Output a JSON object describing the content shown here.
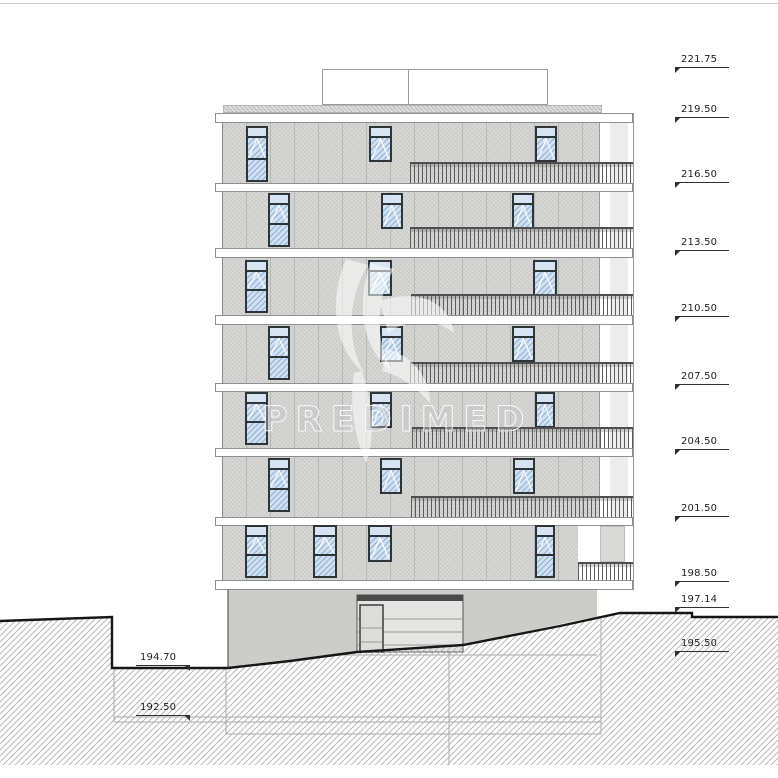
{
  "watermark": {
    "text": "PREDIMED"
  },
  "colors": {
    "facade": "#d8d8d6",
    "slab_border": "#8e8e8e",
    "window_frame": "#2e3539",
    "glazing": "#cfe0f2",
    "railing_bar": "#5c5c5c",
    "terrain_line": "#161616",
    "ground_hatch": "#b0b0b0",
    "structure_line": "#a8a8a8",
    "basement_wall": "#cccdc8",
    "garage_body": "#e4e4e2",
    "garage_top_bar": "#4a4a4a"
  },
  "levels_right": [
    {
      "label": "221.75",
      "y": 68
    },
    {
      "label": "219.50",
      "y": 118
    },
    {
      "label": "216.50",
      "y": 183
    },
    {
      "label": "213.50",
      "y": 251
    },
    {
      "label": "210.50",
      "y": 317
    },
    {
      "label": "207.50",
      "y": 385
    },
    {
      "label": "204.50",
      "y": 450
    },
    {
      "label": "201.50",
      "y": 517
    },
    {
      "label": "198.50",
      "y": 582
    },
    {
      "label": "197.14",
      "y": 608
    },
    {
      "label": "195.50",
      "y": 652
    }
  ],
  "levels_left": [
    {
      "label": "194.70",
      "y": 666,
      "x": 136
    },
    {
      "label": "192.50",
      "y": 716,
      "x": 136
    }
  ],
  "building": {
    "roof": {
      "x": 322,
      "y": 69,
      "w": 226,
      "h": 36,
      "divider_x": 408
    },
    "gravel": {
      "x": 223,
      "y": 105,
      "w": 379,
      "h": 8
    },
    "facade": {
      "x": 222,
      "y": 123,
      "w": 378,
      "h": 457
    },
    "right_zone": {
      "x": 600,
      "y": 123,
      "w": 33,
      "h": 457,
      "band_x": 610,
      "band_w": 18,
      "edge_x": 633,
      "edge_y1": 113,
      "edge_y2": 590
    },
    "slabs": [
      {
        "label": "219.50",
        "x": 215,
        "y": 113,
        "w": 418,
        "h": 10
      },
      {
        "label": "216.50",
        "x": 215,
        "y": 183,
        "w": 418,
        "h": 9
      },
      {
        "label": "213.50",
        "x": 215,
        "y": 248,
        "w": 418,
        "h": 10
      },
      {
        "label": "210.50",
        "x": 215,
        "y": 315,
        "w": 418,
        "h": 10
      },
      {
        "label": "207.50",
        "x": 215,
        "y": 383,
        "w": 418,
        "h": 9
      },
      {
        "label": "204.50",
        "x": 215,
        "y": 448,
        "w": 418,
        "h": 9
      },
      {
        "label": "201.50",
        "x": 215,
        "y": 517,
        "w": 418,
        "h": 9
      },
      {
        "label": "198.50",
        "x": 215,
        "y": 580,
        "w": 418,
        "h": 10
      }
    ],
    "floors": [
      {
        "win_top": 126,
        "short_h": 36,
        "tall_bottom": 182,
        "railing": {
          "x": 410,
          "w": 223,
          "top": 162,
          "h": 21
        },
        "windows": [
          {
            "x": 246,
            "w": 22,
            "type": "tall"
          },
          {
            "x": 369,
            "w": 23,
            "type": "short"
          },
          {
            "x": 535,
            "w": 22,
            "type": "short"
          }
        ]
      },
      {
        "win_top": 193,
        "short_h": 36,
        "tall_bottom": 247,
        "railing": {
          "x": 410,
          "w": 223,
          "top": 227,
          "h": 21
        },
        "windows": [
          {
            "x": 268,
            "w": 22,
            "type": "tall"
          },
          {
            "x": 381,
            "w": 22,
            "type": "short"
          },
          {
            "x": 512,
            "w": 22,
            "type": "short"
          }
        ]
      },
      {
        "win_top": 260,
        "short_h": 36,
        "tall_bottom": 313,
        "railing": {
          "x": 411,
          "w": 222,
          "top": 294,
          "h": 21
        },
        "windows": [
          {
            "x": 245,
            "w": 23,
            "type": "tall"
          },
          {
            "x": 368,
            "w": 24,
            "type": "short"
          },
          {
            "x": 533,
            "w": 24,
            "type": "short"
          }
        ]
      },
      {
        "win_top": 326,
        "short_h": 36,
        "tall_bottom": 380,
        "railing": {
          "x": 410,
          "w": 223,
          "top": 362,
          "h": 21
        },
        "windows": [
          {
            "x": 268,
            "w": 22,
            "type": "tall"
          },
          {
            "x": 380,
            "w": 23,
            "type": "short"
          },
          {
            "x": 512,
            "w": 23,
            "type": "short"
          }
        ]
      },
      {
        "win_top": 392,
        "short_h": 36,
        "tall_bottom": 445,
        "railing": {
          "x": 412,
          "w": 221,
          "top": 427,
          "h": 21
        },
        "windows": [
          {
            "x": 245,
            "w": 23,
            "type": "tall"
          },
          {
            "x": 370,
            "w": 22,
            "type": "short"
          },
          {
            "x": 535,
            "w": 20,
            "type": "short"
          }
        ]
      },
      {
        "win_top": 458,
        "short_h": 36,
        "tall_bottom": 512,
        "railing": {
          "x": 411,
          "w": 222,
          "top": 496,
          "h": 21
        },
        "windows": [
          {
            "x": 268,
            "w": 22,
            "type": "tall"
          },
          {
            "x": 380,
            "w": 22,
            "type": "short"
          },
          {
            "x": 513,
            "w": 22,
            "type": "short"
          }
        ]
      },
      {
        "win_top": 525,
        "short_h": 37,
        "tall_bottom": 578,
        "railing": {
          "x": 578,
          "w": 55,
          "top": 562,
          "h": 18
        },
        "recess": {
          "x": 578,
          "w": 55,
          "top": 526,
          "h": 54,
          "panel_x": 600,
          "panel_w": 25,
          "panel_h": 36
        },
        "windows": [
          {
            "x": 245,
            "w": 23,
            "type": "tall"
          },
          {
            "x": 313,
            "w": 24,
            "type": "tall"
          },
          {
            "x": 368,
            "w": 24,
            "type": "short"
          },
          {
            "x": 535,
            "w": 20,
            "type": "tall"
          }
        ]
      }
    ],
    "garage": {
      "x": 357,
      "y": 595,
      "w": 106,
      "h": 57,
      "top_bar_h": 6,
      "slats": [
        619,
        632,
        645
      ],
      "wicket": {
        "x": 360,
        "y": 605,
        "w": 23,
        "h": 47,
        "lines": [
          628,
          642
        ]
      }
    }
  },
  "terrain": {
    "surface": [
      [
        0,
        621
      ],
      [
        112,
        617
      ],
      [
        112,
        668
      ],
      [
        228,
        668
      ],
      [
        290,
        661
      ],
      [
        357,
        652
      ],
      [
        463,
        645
      ],
      [
        560,
        626
      ],
      [
        620,
        613
      ],
      [
        692,
        613
      ],
      [
        692,
        617
      ],
      [
        778,
        617
      ]
    ],
    "hatch_bottom": 765,
    "basement_poly": [
      [
        228,
        590
      ],
      [
        597,
        590
      ],
      [
        597,
        617
      ],
      [
        580,
        620
      ],
      [
        463,
        645
      ],
      [
        357,
        652
      ],
      [
        290,
        661
      ],
      [
        228,
        668
      ]
    ],
    "left_wall": {
      "x": 228,
      "y1": 590,
      "y2": 668
    },
    "underground_h_lines": [
      [
        114,
        601,
        717
      ],
      [
        114,
        601,
        722
      ],
      [
        226,
        601,
        734
      ],
      [
        230,
        597,
        655
      ]
    ],
    "underground_v_lines": [
      [
        114,
        668,
        722
      ],
      [
        226,
        668,
        734
      ],
      [
        449,
        652,
        765
      ],
      [
        601,
        617,
        734
      ]
    ]
  }
}
